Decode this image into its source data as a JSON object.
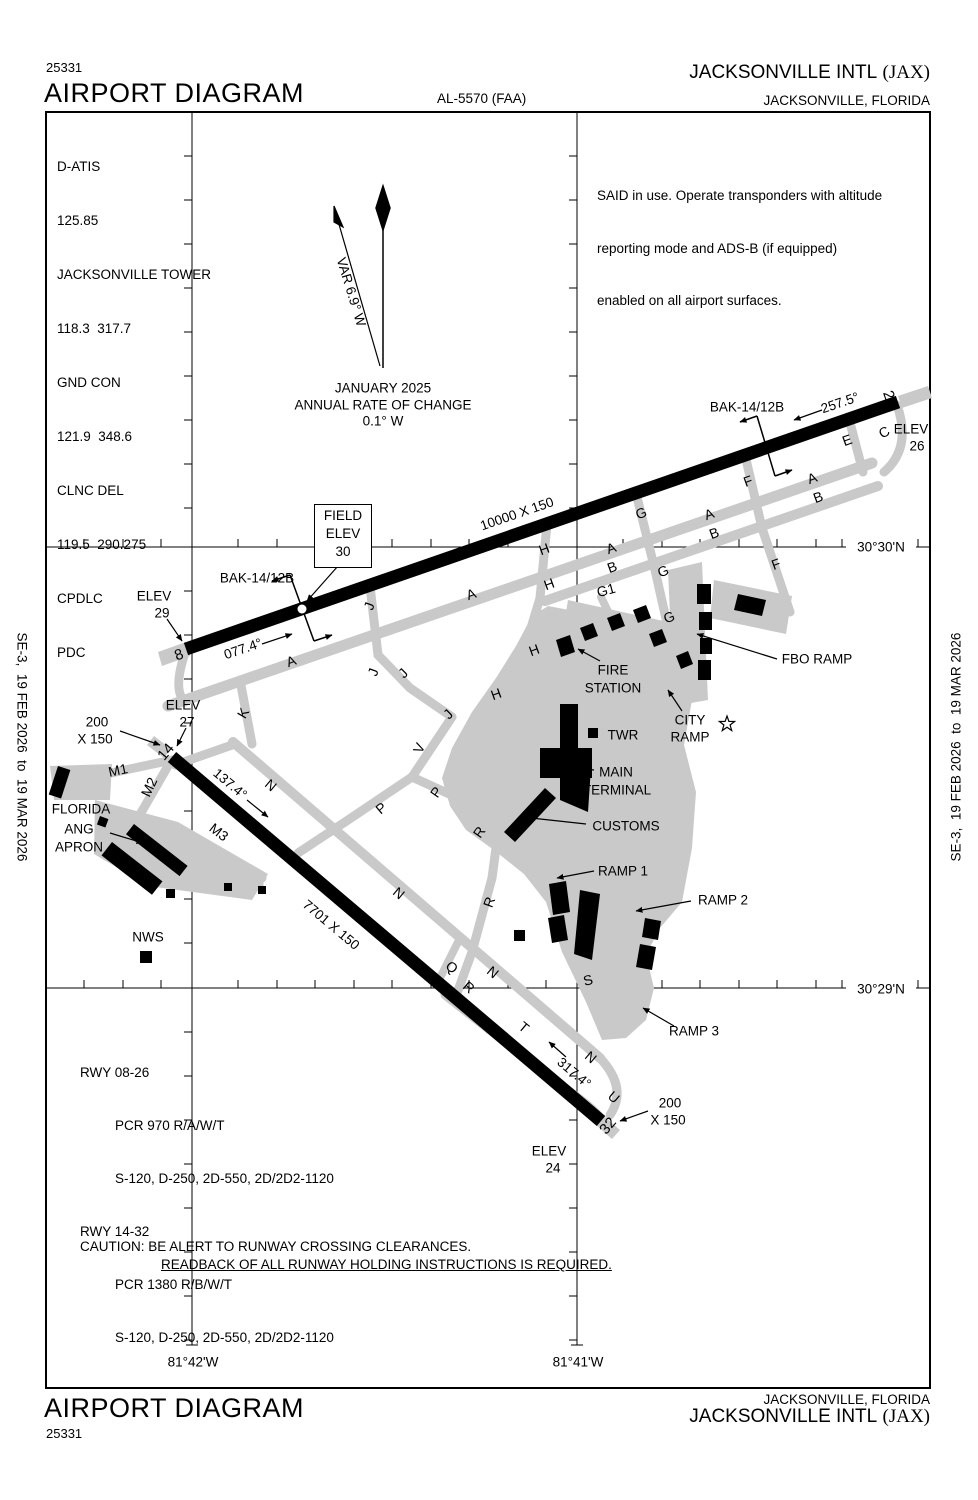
{
  "header": {
    "chart_number": "25331",
    "title": "AIRPORT DIAGRAM",
    "al_number": "AL-5570 (FAA)",
    "airport_name": "JACKSONVILLE INTL",
    "airport_id": "(JAX)",
    "city": "JACKSONVILLE, FLORIDA"
  },
  "footer": {
    "chart_number": "25331",
    "title": "AIRPORT DIAGRAM",
    "airport_name": "JACKSONVILLE INTL",
    "airport_id": "(JAX)",
    "city": "JACKSONVILLE, FLORIDA"
  },
  "sidebars": {
    "left": "SE-3,  19 FEB 2026  to  19 MAR 2026",
    "right": "SE-3,  19 FEB 2026  to  19 MAR 2026"
  },
  "comms": {
    "lines": [
      "D-ATIS",
      "125.85",
      "JACKSONVILLE TOWER",
      "118.3  317.7",
      "GND CON",
      "121.9  348.6",
      "CLNC DEL",
      "119.5  290.275",
      "CPDLC",
      "PDC"
    ]
  },
  "notes": {
    "line1": "SAID in use. Operate transponders with altitude",
    "line2": "reporting mode and ADS-B (if equipped)",
    "line3": "enabled on all airport surfaces."
  },
  "field_elev_box": {
    "line1": "FIELD",
    "line2": "ELEV",
    "line3": "30"
  },
  "runway_data": {
    "lines": [
      "RWY 08-26",
      "PCR 970 R/A/W/T",
      "S-120, D-250, 2D-550, 2D/2D2-1120",
      "RWY 14-32",
      "PCR 1380 R/B/W/T",
      "S-120, D-250, 2D-550, 2D/2D2-1120"
    ]
  },
  "caution": {
    "line1": "CAUTION: BE ALERT TO RUNWAY CROSSING CLEARANCES.",
    "line2": "READBACK OF ALL RUNWAY HOLDING INSTRUCTIONS IS REQUIRED."
  },
  "graticule": {
    "lat_top": "30°30'N",
    "lat_bottom": "30°29'N",
    "lon_left": "81°42'W",
    "lon_right": "81°41'W"
  },
  "colors": {
    "pavement_gray": "#c9c9c9",
    "ink": "#000000"
  },
  "map_labels": [
    {
      "t": "E",
      "x": 847,
      "y": 440,
      "r": -20,
      "fs": 14
    },
    {
      "t": "C",
      "x": 884,
      "y": 432,
      "r": -30,
      "fs": 14
    },
    {
      "t": "F",
      "x": 748,
      "y": 481,
      "r": -20,
      "fs": 14
    },
    {
      "t": "A",
      "x": 812,
      "y": 478,
      "r": -20,
      "fs": 14
    },
    {
      "t": "B",
      "x": 818,
      "y": 497,
      "r": -20,
      "fs": 14
    },
    {
      "t": "A",
      "x": 709,
      "y": 514,
      "r": -20,
      "fs": 14
    },
    {
      "t": "B",
      "x": 714,
      "y": 533,
      "r": -20,
      "fs": 14
    },
    {
      "t": "F",
      "x": 776,
      "y": 564,
      "r": -20,
      "fs": 14
    },
    {
      "t": "G",
      "x": 641,
      "y": 513,
      "r": -20,
      "fs": 14
    },
    {
      "t": "A",
      "x": 611,
      "y": 548,
      "r": -20,
      "fs": 14
    },
    {
      "t": "B",
      "x": 612,
      "y": 567,
      "r": -20,
      "fs": 14
    },
    {
      "t": "G",
      "x": 663,
      "y": 571,
      "r": -20,
      "fs": 14
    },
    {
      "t": "G1",
      "x": 606,
      "y": 590,
      "r": -15,
      "fs": 14
    },
    {
      "t": "G",
      "x": 669,
      "y": 617,
      "r": -20,
      "fs": 14
    },
    {
      "t": "H",
      "x": 544,
      "y": 549,
      "r": -20,
      "fs": 14
    },
    {
      "t": "H",
      "x": 549,
      "y": 584,
      "r": -20,
      "fs": 14
    },
    {
      "t": "A",
      "x": 471,
      "y": 594,
      "r": -20,
      "fs": 14
    },
    {
      "t": "H",
      "x": 534,
      "y": 650,
      "r": -20,
      "fs": 14
    },
    {
      "t": "A",
      "x": 291,
      "y": 661,
      "r": -20,
      "fs": 14
    },
    {
      "t": "J",
      "x": 369,
      "y": 606,
      "r": -70,
      "fs": 14
    },
    {
      "t": "J",
      "x": 373,
      "y": 672,
      "r": -70,
      "fs": 14
    },
    {
      "t": "J",
      "x": 403,
      "y": 673,
      "r": -45,
      "fs": 14
    },
    {
      "t": "J",
      "x": 448,
      "y": 714,
      "r": -45,
      "fs": 14
    },
    {
      "t": "K",
      "x": 243,
      "y": 713,
      "r": -60,
      "fs": 14
    },
    {
      "t": "H",
      "x": 496,
      "y": 694,
      "r": -20,
      "fs": 14
    },
    {
      "t": "V",
      "x": 419,
      "y": 748,
      "r": -65,
      "fs": 14
    },
    {
      "t": "P",
      "x": 436,
      "y": 792,
      "r": -55,
      "fs": 14
    },
    {
      "t": "P",
      "x": 381,
      "y": 808,
      "r": -40,
      "fs": 14
    },
    {
      "t": "R",
      "x": 479,
      "y": 832,
      "r": -55,
      "fs": 14
    },
    {
      "t": "N",
      "x": 271,
      "y": 785,
      "r": 40,
      "fs": 14
    },
    {
      "t": "N",
      "x": 399,
      "y": 893,
      "r": 40,
      "fs": 14
    },
    {
      "t": "R",
      "x": 489,
      "y": 902,
      "r": -70,
      "fs": 14
    },
    {
      "t": "Q",
      "x": 452,
      "y": 967,
      "r": 40,
      "fs": 14
    },
    {
      "t": "R",
      "x": 469,
      "y": 987,
      "r": 40,
      "fs": 14
    },
    {
      "t": "N",
      "x": 493,
      "y": 972,
      "r": 40,
      "fs": 14
    },
    {
      "t": "S",
      "x": 588,
      "y": 980,
      "r": -15,
      "fs": 14
    },
    {
      "t": "T",
      "x": 524,
      "y": 1027,
      "r": 40,
      "fs": 14
    },
    {
      "t": "N",
      "x": 591,
      "y": 1057,
      "r": 40,
      "fs": 14
    },
    {
      "t": "U",
      "x": 614,
      "y": 1097,
      "r": 40,
      "fs": 14
    },
    {
      "t": "M1",
      "x": 118,
      "y": 770,
      "r": -12,
      "fs": 14
    },
    {
      "t": "M2",
      "x": 149,
      "y": 787,
      "r": -65,
      "fs": 14
    },
    {
      "t": "M3",
      "x": 219,
      "y": 832,
      "r": 38,
      "fs": 14
    },
    {
      "t": "8",
      "x": 179,
      "y": 655,
      "r": -20,
      "fs": 15
    },
    {
      "t": "26",
      "x": 890,
      "y": 399,
      "r": 70,
      "fs": 15
    },
    {
      "t": "14",
      "x": 166,
      "y": 752,
      "r": -50,
      "fs": 15
    },
    {
      "t": "32",
      "x": 608,
      "y": 1126,
      "r": -50,
      "fs": 15
    },
    {
      "t": "10000 X 150",
      "x": 517,
      "y": 514,
      "r": -19
    },
    {
      "t": "7701 X 150",
      "x": 331,
      "y": 925,
      "r": 40
    },
    {
      "t": "077.4°",
      "x": 243,
      "y": 649,
      "r": -19
    },
    {
      "t": "257.5°",
      "x": 840,
      "y": 403,
      "r": -19
    },
    {
      "t": "137.4°",
      "x": 230,
      "y": 784,
      "r": 40
    },
    {
      "t": "317.4°",
      "x": 574,
      "y": 1073,
      "r": 40
    },
    {
      "t": "BAK-14/12B",
      "x": 257,
      "y": 578,
      "r": 0
    },
    {
      "t": "BAK-14/12B",
      "x": 747,
      "y": 407,
      "r": 0
    },
    {
      "t": "ELEV",
      "x": 154,
      "y": 596,
      "r": 0
    },
    {
      "t": "29",
      "x": 162,
      "y": 613,
      "r": 0
    },
    {
      "t": "ELEV",
      "x": 911,
      "y": 429,
      "r": 0
    },
    {
      "t": "26",
      "x": 917,
      "y": 446,
      "r": 0
    },
    {
      "t": "ELEV",
      "x": 183,
      "y": 705,
      "r": 0
    },
    {
      "t": "27",
      "x": 187,
      "y": 722,
      "r": 0
    },
    {
      "t": "ELEV",
      "x": 549,
      "y": 1151,
      "r": 0
    },
    {
      "t": "24",
      "x": 553,
      "y": 1168,
      "r": 0
    },
    {
      "t": "200",
      "x": 97,
      "y": 722,
      "r": 0
    },
    {
      "t": "X 150",
      "x": 95,
      "y": 739,
      "r": 0
    },
    {
      "t": "200",
      "x": 670,
      "y": 1103,
      "r": 0
    },
    {
      "t": "X 150",
      "x": 668,
      "y": 1120,
      "r": 0
    },
    {
      "t": "FIRE",
      "x": 613,
      "y": 670,
      "r": 0
    },
    {
      "t": "STATION",
      "x": 613,
      "y": 688,
      "r": 0
    },
    {
      "t": "TWR",
      "x": 623,
      "y": 735,
      "r": 0
    },
    {
      "t": "MAIN",
      "x": 616,
      "y": 772,
      "r": 0
    },
    {
      "t": "TERMINAL",
      "x": 617,
      "y": 790,
      "r": 0
    },
    {
      "t": "CUSTOMS",
      "x": 626,
      "y": 826,
      "r": 0
    },
    {
      "t": "RAMP 1",
      "x": 623,
      "y": 871,
      "r": 0
    },
    {
      "t": "RAMP 2",
      "x": 723,
      "y": 900,
      "r": 0
    },
    {
      "t": "RAMP 3",
      "x": 694,
      "y": 1031,
      "r": 0
    },
    {
      "t": "CITY",
      "x": 690,
      "y": 720,
      "r": 0
    },
    {
      "t": "RAMP",
      "x": 690,
      "y": 737,
      "r": 0
    },
    {
      "t": "FBO RAMP",
      "x": 817,
      "y": 659,
      "r": 0
    },
    {
      "t": "FLORIDA",
      "x": 81,
      "y": 809,
      "r": 0
    },
    {
      "t": "ANG",
      "x": 79,
      "y": 829,
      "r": 0
    },
    {
      "t": "APRON",
      "x": 79,
      "y": 847,
      "r": 0
    },
    {
      "t": "NWS",
      "x": 148,
      "y": 937,
      "r": 0
    },
    {
      "t": "VAR 6.9° W",
      "x": 351,
      "y": 292,
      "r": 73
    },
    {
      "t": "JANUARY 2025",
      "x": 383,
      "y": 388,
      "r": 0
    },
    {
      "t": "ANNUAL RATE OF CHANGE",
      "x": 383,
      "y": 405,
      "r": 0
    },
    {
      "t": "0.1° W",
      "x": 383,
      "y": 421,
      "r": 0
    }
  ]
}
